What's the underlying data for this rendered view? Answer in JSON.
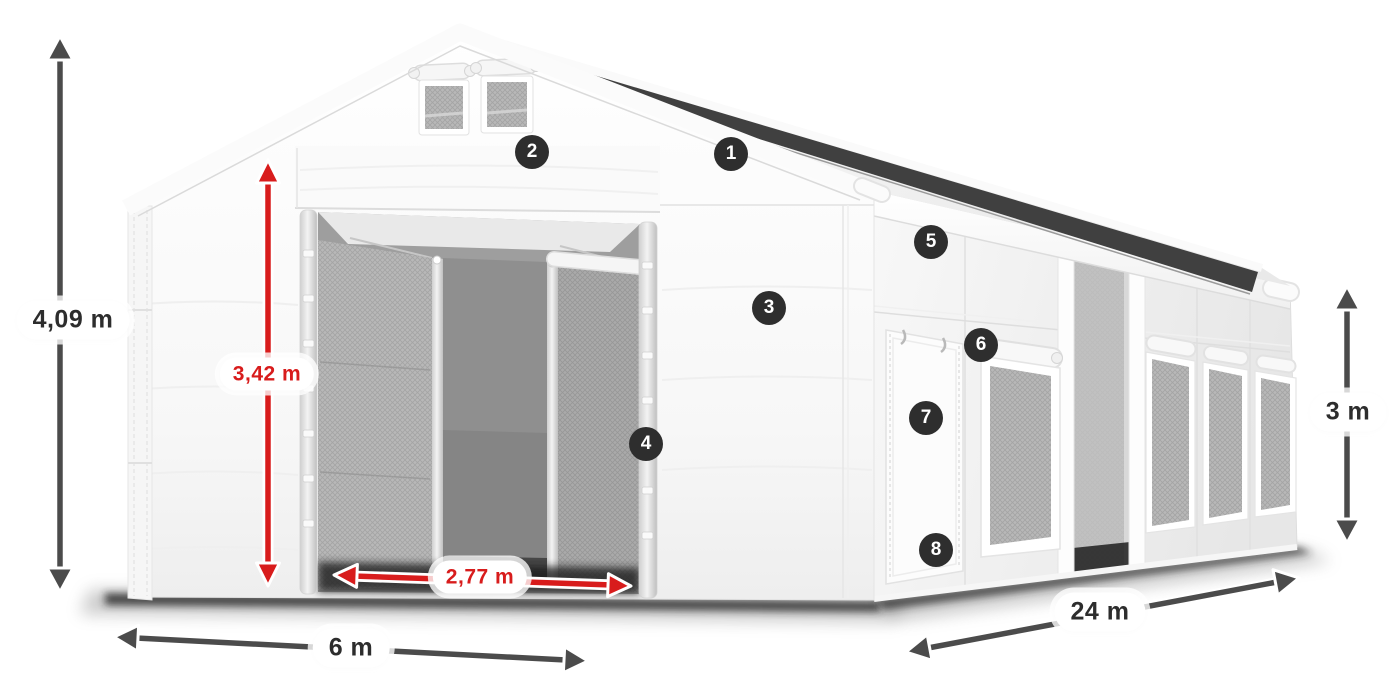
{
  "diagram": {
    "description": "3D product illustration of a white storage tent shown from the front-left corner, with dimension arrows and eight numbered part callouts",
    "background": "#ffffff"
  },
  "dimensions": {
    "total_height": {
      "value": "4,09 m",
      "style": "gray",
      "orientation": "vertical"
    },
    "entrance_height": {
      "value": "3,42 m",
      "style": "red",
      "orientation": "vertical"
    },
    "entrance_width": {
      "value": "2,77 m",
      "style": "red",
      "orientation": "horizontal"
    },
    "front_width": {
      "value": "6 m",
      "style": "gray",
      "orientation": "horizontal"
    },
    "side_length": {
      "value": "24 m",
      "style": "gray",
      "orientation": "diagonal"
    },
    "side_wall_height": {
      "value": "3 m",
      "style": "gray",
      "orientation": "vertical"
    }
  },
  "callouts": [
    {
      "number": "1"
    },
    {
      "number": "2"
    },
    {
      "number": "3"
    },
    {
      "number": "4"
    },
    {
      "number": "5"
    },
    {
      "number": "6"
    },
    {
      "number": "7"
    },
    {
      "number": "8"
    }
  ],
  "colors": {
    "arrow_gray": "#4b4b4b",
    "accent_red": "#d81c1c",
    "badge_background": "#2e2e2e",
    "badge_text": "#ffffff",
    "label_background": "#ffffff",
    "label_text_dark": "#2d2d2d",
    "tent_fabric": "#f7f7f7",
    "mesh_panel": "#b5b5b5",
    "roof_shadow_stripe": "#404040"
  }
}
